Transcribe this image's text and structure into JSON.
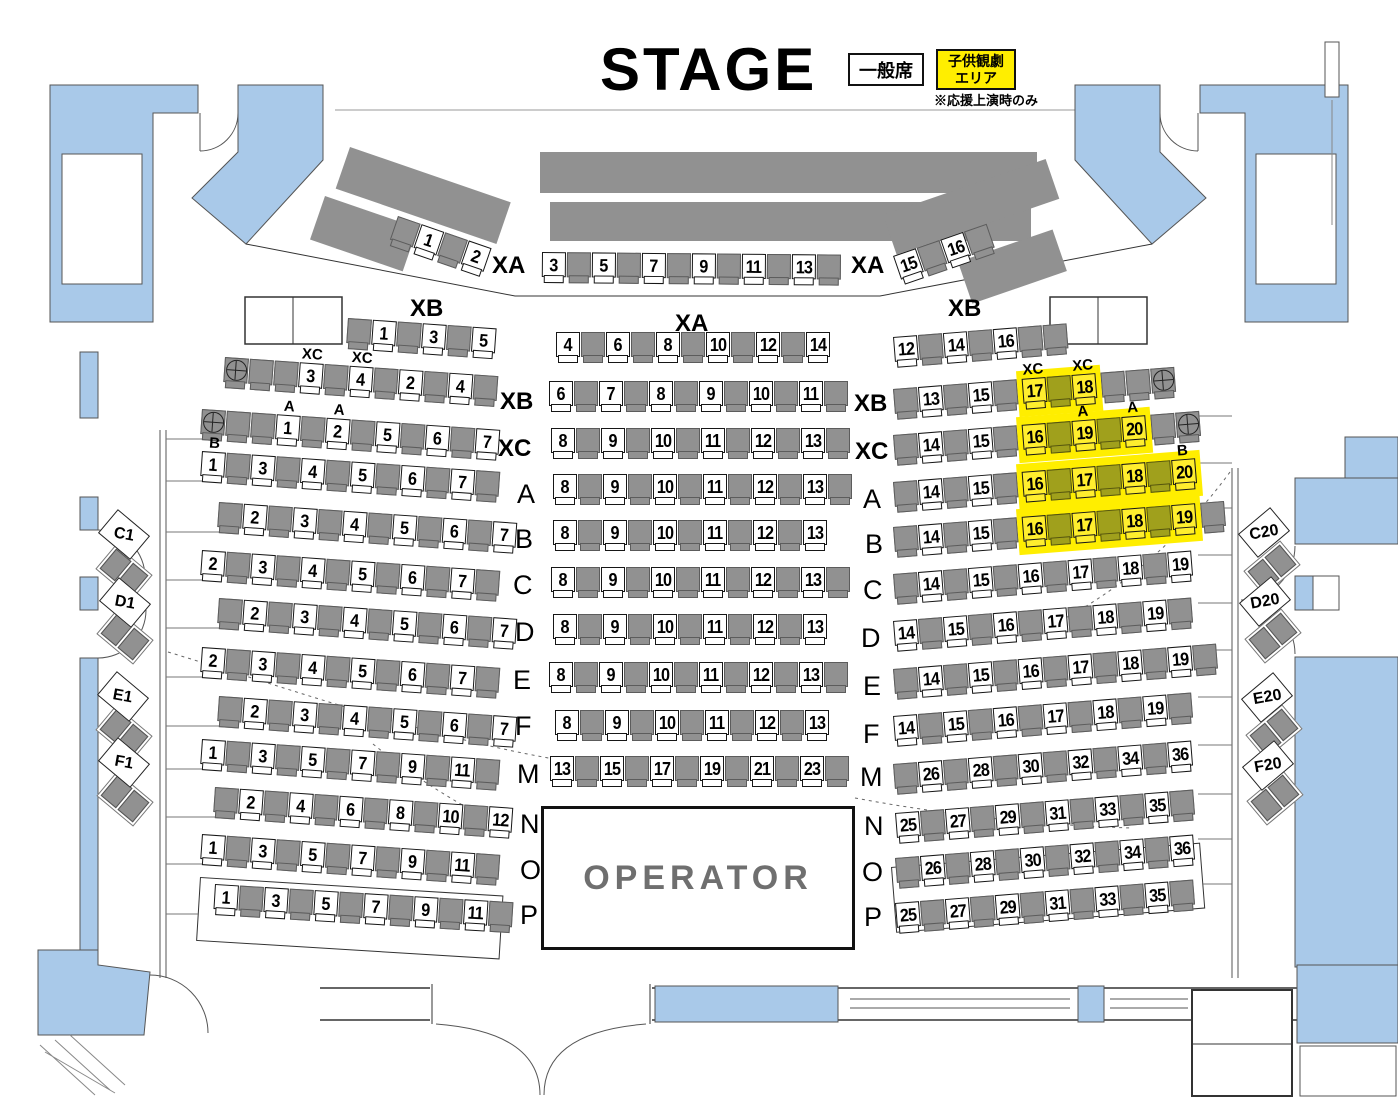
{
  "title": {
    "stage": "STAGE"
  },
  "legend": {
    "general_label": "一般席",
    "kids_line1": "子供観劇",
    "kids_line2": "エリア",
    "note": "※応援上演時のみ"
  },
  "operator": {
    "label": "OPERATOR"
  },
  "colors": {
    "wall_blue": "#a9c9e9",
    "seat_gray": "#919191",
    "kids_yellow": "#ffee00",
    "kids_seat_olive": "#a0a01c"
  },
  "side_seats": {
    "left": [
      "C1",
      "D1",
      "E1",
      "F1"
    ],
    "right": [
      "C20",
      "D20",
      "E20",
      "F20"
    ]
  },
  "rows": [
    {
      "id": "XA",
      "label_left": "XA",
      "label_right": "XA",
      "diagL": [
        ".",
        "1",
        ".",
        "2"
      ],
      "center": [
        "3",
        ".",
        "5",
        ".",
        "7",
        ".",
        "9",
        ".",
        "11",
        ".",
        "13",
        "."
      ],
      "diagR": [
        "15",
        ".",
        "16",
        "."
      ]
    },
    {
      "id": "XA2",
      "label_left": "XB",
      "label_center": "XA",
      "label_right": "XB",
      "left": [
        ".",
        "1",
        ".",
        "3",
        ".",
        "5"
      ],
      "center": [
        "4",
        ".",
        "6",
        ".",
        "8",
        ".",
        "10",
        ".",
        "12",
        ".",
        "14"
      ],
      "right": [
        "12",
        ".",
        "14",
        ".",
        "16",
        ".",
        "."
      ]
    },
    {
      "id": "XB",
      "label_left": "XB",
      "label_right": "XB",
      "left": [
        "*",
        ".",
        ".",
        "3^XC",
        ".",
        "4^XC",
        ".",
        "2",
        ".",
        "4",
        "."
      ],
      "center": [
        "6",
        ".",
        "7",
        ".",
        "8",
        ".",
        "9",
        ".",
        "10",
        ".",
        "11",
        "."
      ],
      "right": [
        ".",
        "13",
        ".",
        "15",
        ".",
        "y17^XC",
        "o",
        "y18^XC",
        ".",
        ".",
        "*"
      ]
    },
    {
      "id": "XC",
      "label_left": "XC",
      "label_right": "XC",
      "left": [
        "*",
        ".",
        ".",
        "1^A",
        ".",
        "2^A",
        ".",
        "5",
        ".",
        "6",
        ".",
        "7"
      ],
      "center": [
        "8",
        ".",
        "9",
        ".",
        "10",
        ".",
        "11",
        ".",
        "12",
        ".",
        "13",
        "."
      ],
      "right": [
        ".",
        "14",
        ".",
        "15",
        ".",
        "y16",
        "o",
        "y19^A",
        "o",
        "y20^A",
        ".",
        "*"
      ]
    },
    {
      "id": "A",
      "label_left": "A",
      "label_right": "A",
      "left": [
        "1^B",
        ".",
        "3",
        ".",
        "4",
        ".",
        "5",
        ".",
        "6",
        ".",
        "7",
        "."
      ],
      "center": [
        "8",
        ".",
        "9",
        ".",
        "10",
        ".",
        "11",
        ".",
        "12",
        ".",
        "13",
        "."
      ],
      "right": [
        ".",
        "14",
        ".",
        "15",
        ".",
        "y16",
        "o",
        "y17",
        "o",
        "y18",
        "o",
        "y20^B"
      ]
    },
    {
      "id": "B",
      "label_left": "B",
      "label_right": "B",
      "left": [
        ".",
        "2",
        ".",
        "3",
        ".",
        "4",
        ".",
        "5",
        ".",
        "6",
        ".",
        "7"
      ],
      "center": [
        "8",
        ".",
        "9",
        ".",
        "10",
        ".",
        "11",
        ".",
        "12",
        ".",
        "13"
      ],
      "right": [
        ".",
        "14",
        ".",
        "15",
        ".",
        "y16",
        "o",
        "y17",
        "o",
        "y18",
        "o",
        "y19",
        "."
      ]
    },
    {
      "id": "C",
      "label_left": "C",
      "label_right": "C",
      "left": [
        "2",
        ".",
        "3",
        ".",
        "4",
        ".",
        "5",
        ".",
        "6",
        ".",
        "7",
        "."
      ],
      "center": [
        "8",
        ".",
        "9",
        ".",
        "10",
        ".",
        "11",
        ".",
        "12",
        ".",
        "13",
        "."
      ],
      "right": [
        ".",
        "14",
        ".",
        "15",
        ".",
        "16",
        ".",
        "17",
        ".",
        "18",
        ".",
        "19"
      ]
    },
    {
      "id": "D",
      "label_left": "D",
      "label_right": "D",
      "left": [
        ".",
        "2",
        ".",
        "3",
        ".",
        "4",
        ".",
        "5",
        ".",
        "6",
        ".",
        "7"
      ],
      "center": [
        "8",
        ".",
        "9",
        ".",
        "10",
        ".",
        "11",
        ".",
        "12",
        ".",
        "13"
      ],
      "right": [
        "14",
        ".",
        "15",
        ".",
        "16",
        ".",
        "17",
        ".",
        "18",
        ".",
        "19",
        "."
      ]
    },
    {
      "id": "E",
      "label_left": "E",
      "label_right": "E",
      "left": [
        "2",
        ".",
        "3",
        ".",
        "4",
        ".",
        "5",
        ".",
        "6",
        ".",
        "7",
        "."
      ],
      "center": [
        "8",
        ".",
        "9",
        ".",
        "10",
        ".",
        "11",
        ".",
        "12",
        ".",
        "13",
        "."
      ],
      "right": [
        ".",
        "14",
        ".",
        "15",
        ".",
        "16",
        ".",
        "17",
        ".",
        "18",
        ".",
        "19",
        "."
      ]
    },
    {
      "id": "F",
      "label_left": "F",
      "label_right": "F",
      "left": [
        ".",
        "2",
        ".",
        "3",
        ".",
        "4",
        ".",
        "5",
        ".",
        "6",
        ".",
        "7"
      ],
      "center": [
        "8",
        ".",
        "9",
        ".",
        "10",
        ".",
        "11",
        ".",
        "12",
        ".",
        "13"
      ],
      "right": [
        "14",
        ".",
        "15",
        ".",
        "16",
        ".",
        "17",
        ".",
        "18",
        ".",
        "19",
        "."
      ]
    },
    {
      "id": "M",
      "label_left": "M",
      "label_right": "M",
      "left": [
        "1",
        ".",
        "3",
        ".",
        "5",
        ".",
        "7",
        ".",
        "9",
        ".",
        "11",
        "."
      ],
      "center": [
        "13",
        ".",
        "15",
        ".",
        "17",
        ".",
        "19",
        ".",
        "21",
        ".",
        "23",
        "."
      ],
      "right": [
        ".",
        "26",
        ".",
        "28",
        ".",
        "30",
        ".",
        "32",
        ".",
        "34",
        ".",
        "36"
      ]
    },
    {
      "id": "N",
      "label_left": "N",
      "label_right": "N",
      "left": [
        ".",
        "2",
        ".",
        "4",
        ".",
        "6",
        ".",
        "8",
        ".",
        "10",
        ".",
        "12"
      ],
      "right": [
        "25",
        ".",
        "27",
        ".",
        "29",
        ".",
        "31",
        ".",
        "33",
        ".",
        "35",
        "."
      ]
    },
    {
      "id": "O",
      "label_left": "O",
      "label_right": "O",
      "left": [
        "1",
        ".",
        "3",
        ".",
        "5",
        ".",
        "7",
        ".",
        "9",
        ".",
        "11",
        "."
      ],
      "right": [
        ".",
        "26",
        ".",
        "28",
        ".",
        "30",
        ".",
        "32",
        ".",
        "34",
        ".",
        "36"
      ]
    },
    {
      "id": "P",
      "label_left": "P",
      "label_right": "P",
      "left": [
        "1",
        ".",
        "3",
        ".",
        "5",
        ".",
        "7",
        ".",
        "9",
        ".",
        "11",
        "."
      ],
      "right": [
        "25",
        ".",
        "27",
        ".",
        "29",
        ".",
        "31",
        ".",
        "33",
        ".",
        "35",
        "."
      ]
    }
  ]
}
